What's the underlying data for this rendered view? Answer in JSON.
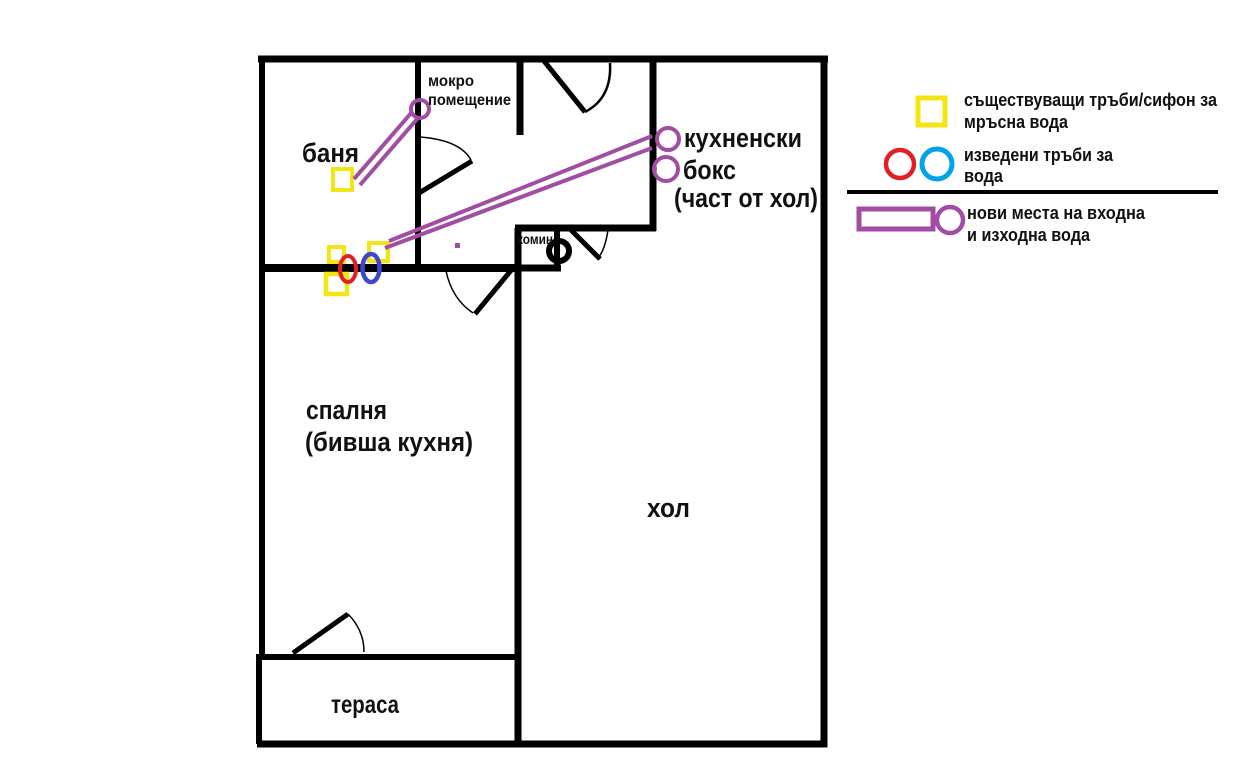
{
  "colors": {
    "wall": "#000000",
    "yellow": "#f3e512",
    "red": "#e02025",
    "indigo": "#3f48cc",
    "turquoise": "#00a2e8",
    "purple": "#a04da3"
  },
  "rooms": {
    "banya": "баня",
    "mokro1": "мокро",
    "mokro2": "помещение",
    "kitchen1": "кухненски",
    "kitchen2": "бокс",
    "kitchen3": "(част от хол)",
    "komin": "комин",
    "bedroom1": "спалня",
    "bedroom2": "(бивша кухня)",
    "hall": "хол",
    "terrace": "тераса"
  },
  "legend": {
    "existing1": "съществуващи тръби/сифон за",
    "existing2": "мръсна вода",
    "routed1": "изведени тръби за",
    "routed2": "вода",
    "new1": "нови места на входна",
    "new2": "и изходна вода"
  }
}
